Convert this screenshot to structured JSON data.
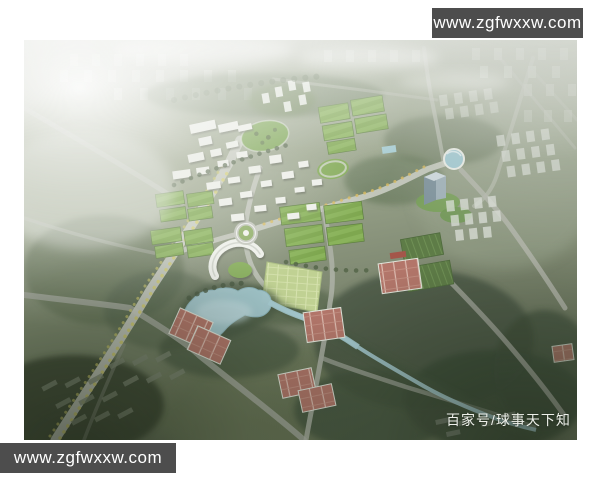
{
  "page": {
    "background_color": "#ffffff"
  },
  "photo": {
    "description": "aerial-masterplan-rendering-of-lakeside-sports-park",
    "colors": {
      "haze": "#c3c7bd",
      "land": "#9aa48d",
      "forest": "#44523e",
      "field_green": "#7ea74f",
      "water": "#a6cbd2",
      "court_clay": "#b3766a",
      "road": "#c5c8be",
      "building_white": "#edefe9",
      "vignette": "#1f2819"
    },
    "features": [
      "foggy-city-skyline",
      "campus-buildings",
      "sports-fields",
      "oval-tree-park",
      "running-track",
      "roundabout",
      "crescent-stadium",
      "lake",
      "winding-river",
      "tennis-court-clusters",
      "circular-pond",
      "glass-tower",
      "tree-lined-boulevard",
      "residential-blocks"
    ]
  },
  "watermark_top_right": {
    "text": "www.zgfwxxw.com",
    "background": "#4d4d4d",
    "text_color": "#ffffff"
  },
  "watermark_bottom_left": {
    "text": "www.zgfwxxw.com",
    "background": "#4d4d4d",
    "text_color": "#ffffff"
  },
  "byline": {
    "text": "百家号/球事天下知",
    "text_color": "#edefe9"
  }
}
